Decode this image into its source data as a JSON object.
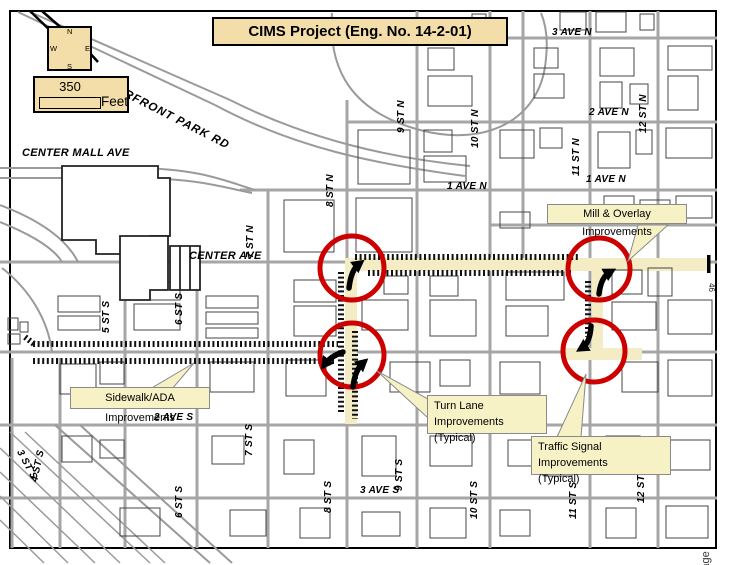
{
  "title": "CIMS Project (Eng. No. 14-2-01)",
  "compass": {
    "north": "N",
    "south": "S",
    "east": "E",
    "west": "W"
  },
  "scale_bar": {
    "distance": "350",
    "unit": "Feet"
  },
  "street_labels": [
    {
      "id": "riverfront-park-rd",
      "text": "RIVERFRONT PARK RD"
    },
    {
      "id": "center-mall-ave",
      "text": "CENTER MALL AVE"
    },
    {
      "id": "center-ave",
      "text": "CENTER AVE"
    },
    {
      "id": "ave-3-n",
      "text": "3 AVE N"
    },
    {
      "id": "ave-2-n",
      "text": "2 AVE N"
    },
    {
      "id": "ave-1-n-west",
      "text": "1 AVE N"
    },
    {
      "id": "ave-1-n-east",
      "text": "1 AVE N"
    },
    {
      "id": "ave-2-s",
      "text": "2 AVE S"
    },
    {
      "id": "ave-3-s",
      "text": "3 AVE S"
    },
    {
      "id": "st-7-n",
      "text": "7 ST N"
    },
    {
      "id": "st-8-n",
      "text": "8 ST N"
    },
    {
      "id": "st-9-n",
      "text": "9 ST N"
    },
    {
      "id": "st-10-n",
      "text": "10 ST N"
    },
    {
      "id": "st-11-n",
      "text": "11 ST N"
    },
    {
      "id": "st-12-n",
      "text": "12 ST N"
    },
    {
      "id": "st-5-s",
      "text": "5 ST S"
    },
    {
      "id": "st-6-s",
      "text": "6 ST S"
    },
    {
      "id": "st-7-s",
      "text": "7 ST S"
    },
    {
      "id": "st-8-s",
      "text": "8 ST S"
    },
    {
      "id": "st-9-s",
      "text": "9 ST S"
    },
    {
      "id": "st-10-s",
      "text": "10 ST S"
    },
    {
      "id": "st-11-s",
      "text": "11 ST S"
    },
    {
      "id": "st-12-s",
      "text": "12 ST S"
    },
    {
      "id": "st-6-s-lower",
      "text": "6 ST S"
    },
    {
      "id": "st-3-s",
      "text": "3 ST S"
    },
    {
      "id": "st-4-s",
      "text": "4 ST S"
    }
  ],
  "callouts": {
    "mill_overlay": {
      "text": "Mill & Overlay Improvements"
    },
    "sidewalk_ada": {
      "text": "Sidewalk/ADA Improvements"
    },
    "turn_lane": {
      "line1": "Turn Lane Improvements",
      "line2": "(Typical)"
    },
    "traffic_signal": {
      "line1": "Traffic Signal Improvements",
      "line2": "(Typical)"
    }
  },
  "margin_labels": {
    "route_marker": "46",
    "page_text": "Page"
  },
  "colors": {
    "panel_tan": "#f3dda9",
    "callout_yellow": "#f6f2c6",
    "highlight_road": "#f3ecc4",
    "circle_red": "#cc0000",
    "street_gray": "#a6a6a6"
  }
}
